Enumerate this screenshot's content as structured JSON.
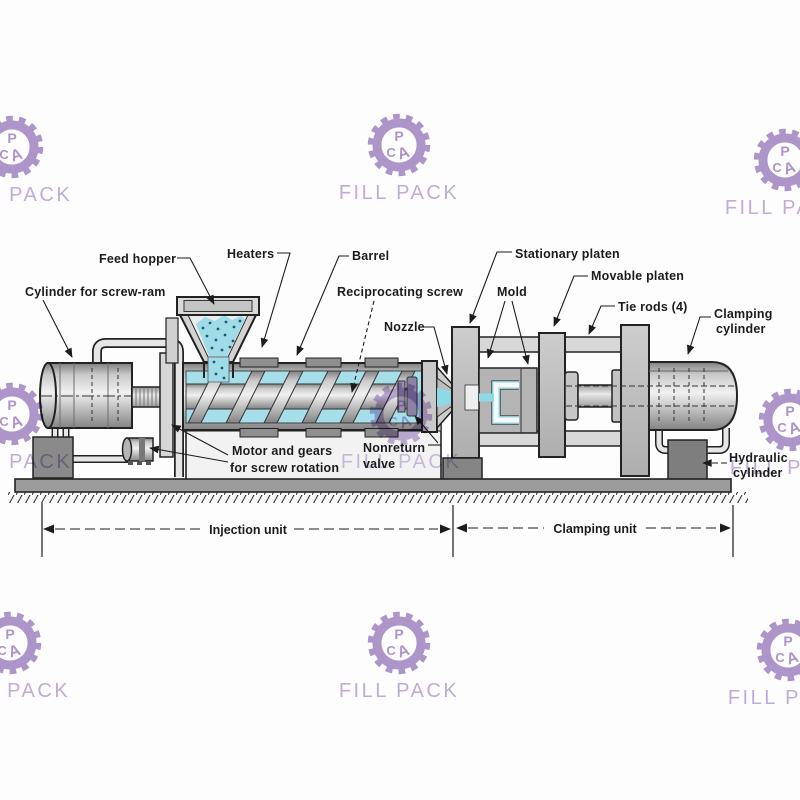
{
  "watermark": {
    "brand": "FILL PACK",
    "logo_letters": {
      "p": "P",
      "c": "C",
      "a": "A"
    },
    "color": "#9b7cc0",
    "text_color": "#b29ad0"
  },
  "diagram": {
    "labels": {
      "cylinder_screw_ram": "Cylinder for screw-ram",
      "feed_hopper": "Feed hopper",
      "heaters": "Heaters",
      "barrel": "Barrel",
      "reciprocating_screw": "Reciprocating screw",
      "nozzle": "Nozzle",
      "stationary_platen": "Stationary platen",
      "mold": "Mold",
      "movable_platen": "Movable platen",
      "tie_rods": "Tie rods (4)",
      "clamping_cylinder_line1": "Clamping",
      "clamping_cylinder_line2": "cylinder",
      "motor_gears_line1": "Motor and gears",
      "motor_gears_line2": "for screw rotation",
      "nonreturn_valve_line1": "Nonreturn",
      "nonreturn_valve_line2": "valve",
      "hydraulic_cylinder_line1": "Hydraulic",
      "hydraulic_cylinder_line2": "cylinder"
    },
    "dimensions": {
      "injection_unit": "Injection unit",
      "clamping_unit": "Clamping unit"
    },
    "colors": {
      "material_cyan": "#8fd9e7",
      "metal_light": "#d9d9d9",
      "metal_dark": "#8a8a8a",
      "outline": "#222222"
    }
  }
}
